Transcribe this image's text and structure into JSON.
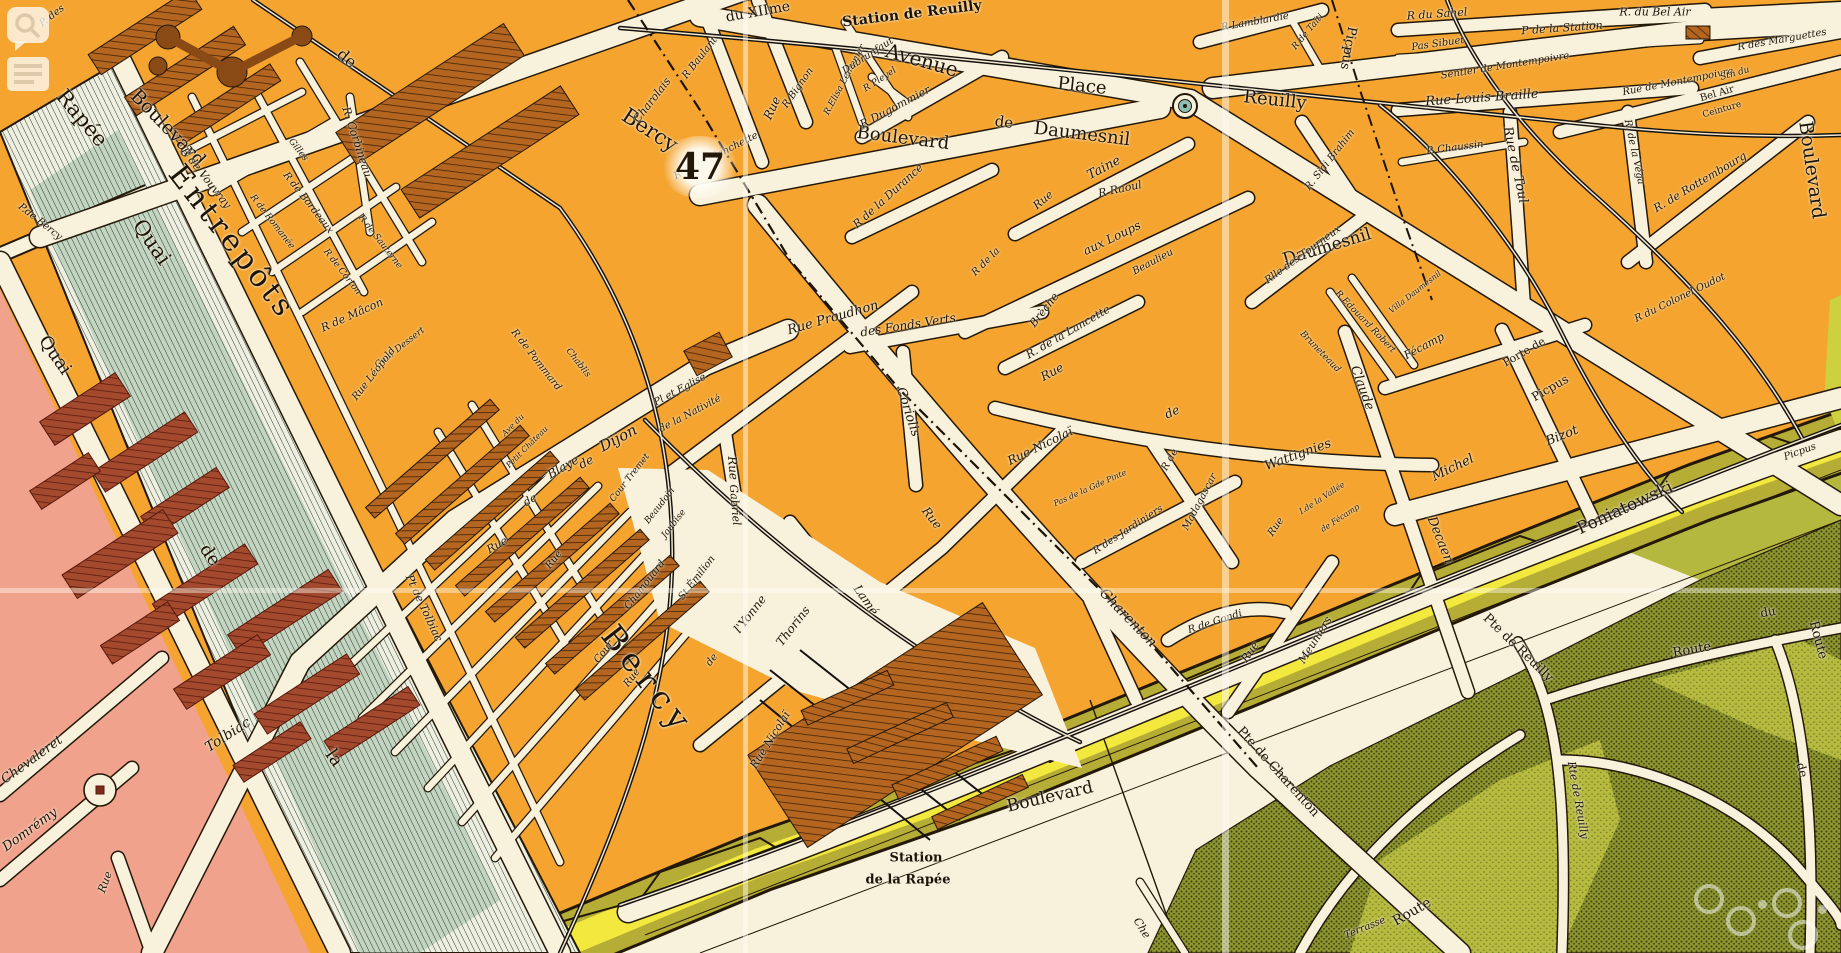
{
  "map": {
    "sheet_number": "47",
    "description_labels": {
      "station_line1": "Station",
      "station_line2": "de la Rapée"
    },
    "colors": {
      "block_orange": "#f4a42f",
      "street_cream": "#f8f1dc",
      "building_hatch": "#b4651f",
      "left_bank_pink": "#f0a28c",
      "left_bank_building": "#a2492e",
      "river_hatch_base": "#edf0e1",
      "river_teal": "#9fc0a8",
      "fortification_yellow": "#f2e83e",
      "fortification_olive": "#b5ad35",
      "park_dark": "#8d9430",
      "park_light": "#b6bb40",
      "ink": "#241808",
      "place_circle_teal": "#8fbfb4"
    },
    "overlay_icons": [
      "speech-bubble-magnifier-icon",
      "text-lines-icon",
      "watermark-rings"
    ],
    "labels": [
      {
        "t": "P. des",
        "x": 52,
        "y": 16,
        "r": -38,
        "s": 10,
        "i": 1
      },
      {
        "t": "Rapée",
        "x": 82,
        "y": 118,
        "r": 50,
        "s": 21
      },
      {
        "t": "Quai",
        "x": 152,
        "y": 242,
        "r": 55,
        "s": 21
      },
      {
        "t": "P.de Bercy",
        "x": 40,
        "y": 222,
        "r": 38,
        "s": 10,
        "i": 1
      },
      {
        "t": "Boulevard",
        "x": 168,
        "y": 128,
        "r": 46,
        "s": 19
      },
      {
        "t": "de",
        "x": 347,
        "y": 58,
        "r": 40,
        "s": 16
      },
      {
        "t": "Bercy",
        "x": 650,
        "y": 130,
        "r": 33,
        "s": 21
      },
      {
        "t": "du XIIme",
        "x": 758,
        "y": 12,
        "r": -10,
        "s": 14
      },
      {
        "t": "Station de Reuilly",
        "x": 912,
        "y": 14,
        "r": -7,
        "s": 14,
        "b": 1
      },
      {
        "t": "Avenue",
        "x": 922,
        "y": 60,
        "r": 16,
        "s": 20
      },
      {
        "t": "Place",
        "x": 1082,
        "y": 86,
        "r": 6,
        "s": 18
      },
      {
        "t": "Reuilly",
        "x": 1275,
        "y": 100,
        "r": 6,
        "s": 18
      },
      {
        "t": "Boulevard",
        "x": 903,
        "y": 138,
        "r": 7,
        "s": 18
      },
      {
        "t": "de",
        "x": 1004,
        "y": 122,
        "r": 7,
        "s": 15
      },
      {
        "t": "Daumesnil",
        "x": 1082,
        "y": 134,
        "r": 7,
        "s": 18
      },
      {
        "t": "Daumesnil",
        "x": 1327,
        "y": 247,
        "r": -17,
        "s": 17
      },
      {
        "t": "R Baulant",
        "x": 700,
        "y": 58,
        "r": -52,
        "s": 10,
        "i": 1
      },
      {
        "t": "Charolais",
        "x": 652,
        "y": 100,
        "r": -52,
        "s": 11,
        "i": 1
      },
      {
        "t": "R Bignon",
        "x": 798,
        "y": 88,
        "r": -55,
        "s": 10,
        "i": 1
      },
      {
        "t": "Rue",
        "x": 772,
        "y": 108,
        "r": -65,
        "s": 12,
        "i": 1
      },
      {
        "t": "R de la Planchette",
        "x": 716,
        "y": 156,
        "r": -27,
        "s": 10,
        "i": 1
      },
      {
        "t": "R.Elisa Lemonier",
        "x": 845,
        "y": 80,
        "r": -62,
        "s": 9,
        "i": 1
      },
      {
        "t": "Dubrunfaut",
        "x": 868,
        "y": 56,
        "r": -33,
        "s": 10,
        "i": 1
      },
      {
        "t": "R Pleyel",
        "x": 880,
        "y": 80,
        "r": -33,
        "s": 9,
        "i": 1
      },
      {
        "t": "R Dugommier",
        "x": 895,
        "y": 107,
        "r": -28,
        "s": 11,
        "i": 1
      },
      {
        "t": "R de la Durance",
        "x": 888,
        "y": 196,
        "r": -42,
        "s": 11,
        "i": 1
      },
      {
        "t": "Rue",
        "x": 1043,
        "y": 200,
        "r": -40,
        "s": 11,
        "i": 1
      },
      {
        "t": "Taine",
        "x": 1104,
        "y": 168,
        "r": -28,
        "s": 13,
        "i": 1
      },
      {
        "t": "R Raoul",
        "x": 1120,
        "y": 189,
        "r": -12,
        "s": 11,
        "i": 1
      },
      {
        "t": "R de la",
        "x": 986,
        "y": 262,
        "r": -45,
        "s": 10,
        "i": 1
      },
      {
        "t": "Brèche",
        "x": 1044,
        "y": 310,
        "r": -52,
        "s": 11,
        "i": 1
      },
      {
        "t": "aux Loups",
        "x": 1112,
        "y": 238,
        "r": -26,
        "s": 12,
        "i": 1
      },
      {
        "t": "Beaulieu",
        "x": 1153,
        "y": 262,
        "r": -28,
        "s": 10,
        "i": 1
      },
      {
        "t": "R Lamblardie",
        "x": 1255,
        "y": 22,
        "r": -10,
        "s": 10,
        "i": 1
      },
      {
        "t": "R de Taïti",
        "x": 1308,
        "y": 32,
        "r": -50,
        "s": 9,
        "i": 1
      },
      {
        "t": "Picpus",
        "x": 1348,
        "y": 48,
        "r": 100,
        "s": 13
      },
      {
        "t": "R. Sidi Brahim",
        "x": 1330,
        "y": 160,
        "r": -52,
        "s": 10,
        "i": 1
      },
      {
        "t": "Rlle des Tourneux",
        "x": 1303,
        "y": 255,
        "r": -36,
        "s": 10,
        "i": 1
      },
      {
        "t": "R.Edouard Robert",
        "x": 1365,
        "y": 322,
        "r": 46,
        "s": 9,
        "i": 1
      },
      {
        "t": "Bruneteaud",
        "x": 1320,
        "y": 352,
        "r": 46,
        "s": 9,
        "i": 1
      },
      {
        "t": "Villa Daumesnil",
        "x": 1415,
        "y": 292,
        "r": -38,
        "s": 8,
        "i": 1
      },
      {
        "t": "Fécamp",
        "x": 1424,
        "y": 346,
        "r": -28,
        "s": 11,
        "i": 1
      },
      {
        "t": "Claude",
        "x": 1362,
        "y": 388,
        "r": 70,
        "s": 13,
        "i": 1
      },
      {
        "t": "Decaen",
        "x": 1440,
        "y": 540,
        "r": 68,
        "s": 13,
        "i": 1
      },
      {
        "t": "Michel",
        "x": 1453,
        "y": 468,
        "r": -26,
        "s": 13,
        "i": 1
      },
      {
        "t": "Bizot",
        "x": 1562,
        "y": 436,
        "r": -22,
        "s": 13,
        "i": 1
      },
      {
        "t": "Wattignies",
        "x": 1298,
        "y": 455,
        "r": -20,
        "s": 13,
        "i": 1
      },
      {
        "t": "de",
        "x": 1172,
        "y": 412,
        "r": -25,
        "s": 12,
        "i": 1
      },
      {
        "t": "Rue",
        "x": 1052,
        "y": 372,
        "r": -28,
        "s": 12,
        "i": 1
      },
      {
        "t": "Rue Nicolaï",
        "x": 1040,
        "y": 446,
        "r": -26,
        "s": 12,
        "i": 1
      },
      {
        "t": "R. de la Lancette",
        "x": 1068,
        "y": 332,
        "r": -30,
        "s": 11,
        "i": 1
      },
      {
        "t": "Pas de la Gde Pinte",
        "x": 1090,
        "y": 488,
        "r": -24,
        "s": 8,
        "i": 1
      },
      {
        "t": "R de",
        "x": 1170,
        "y": 460,
        "r": -60,
        "s": 10,
        "i": 1
      },
      {
        "t": "Madagascar",
        "x": 1200,
        "y": 502,
        "r": -62,
        "s": 10,
        "i": 1
      },
      {
        "t": "R des Jardiniers",
        "x": 1128,
        "y": 530,
        "r": -33,
        "s": 10,
        "i": 1
      },
      {
        "t": "Rue",
        "x": 1276,
        "y": 527,
        "r": -55,
        "s": 10,
        "i": 1
      },
      {
        "t": "Rue",
        "x": 1250,
        "y": 652,
        "r": -55,
        "s": 11,
        "i": 1
      },
      {
        "t": "Meuniers",
        "x": 1315,
        "y": 640,
        "r": -58,
        "s": 11,
        "i": 1
      },
      {
        "t": "R de Gondi",
        "x": 1215,
        "y": 622,
        "r": -18,
        "s": 10,
        "i": 1
      },
      {
        "t": "I.de la Vallée",
        "x": 1322,
        "y": 498,
        "r": -33,
        "s": 8,
        "i": 1
      },
      {
        "t": "de Fécamp",
        "x": 1340,
        "y": 518,
        "r": -33,
        "s": 8,
        "i": 1
      },
      {
        "t": "Charenton",
        "x": 1128,
        "y": 618,
        "r": 46,
        "s": 14,
        "i": 1
      },
      {
        "t": "Rue",
        "x": 932,
        "y": 518,
        "r": 52,
        "s": 12,
        "i": 1
      },
      {
        "t": "Coriolis",
        "x": 908,
        "y": 412,
        "r": 72,
        "s": 13,
        "i": 1
      },
      {
        "t": "Rue Proudhon",
        "x": 833,
        "y": 318,
        "r": -16,
        "s": 13,
        "i": 1
      },
      {
        "t": "des Fonds Verts",
        "x": 908,
        "y": 325,
        "r": -9,
        "s": 12,
        "i": 1
      },
      {
        "t": "Pl et Eglise",
        "x": 680,
        "y": 390,
        "r": -28,
        "s": 10,
        "i": 1
      },
      {
        "t": "de la Nativité",
        "x": 690,
        "y": 414,
        "r": -28,
        "s": 10,
        "i": 1
      },
      {
        "t": "Rue",
        "x": 733,
        "y": 468,
        "r": 85,
        "s": 12,
        "i": 1
      },
      {
        "t": "Gabriel",
        "x": 735,
        "y": 505,
        "r": 85,
        "s": 11,
        "i": 1
      },
      {
        "t": "Lamé",
        "x": 866,
        "y": 600,
        "r": 55,
        "s": 12,
        "i": 1
      },
      {
        "t": "de",
        "x": 586,
        "y": 462,
        "r": -28,
        "s": 12,
        "i": 1
      },
      {
        "t": "Dijon",
        "x": 618,
        "y": 438,
        "r": -28,
        "s": 15,
        "i": 1
      },
      {
        "t": "Rue",
        "x": 497,
        "y": 545,
        "r": -30,
        "s": 11,
        "i": 1
      },
      {
        "t": "de",
        "x": 530,
        "y": 500,
        "r": -30,
        "s": 11,
        "i": 1
      },
      {
        "t": "Blaye",
        "x": 563,
        "y": 467,
        "r": -30,
        "s": 12,
        "i": 1
      },
      {
        "t": "Ave du",
        "x": 513,
        "y": 425,
        "r": -45,
        "s": 8,
        "i": 1
      },
      {
        "t": "Petit Château",
        "x": 527,
        "y": 447,
        "r": -45,
        "s": 8,
        "i": 1
      },
      {
        "t": "R de Pommard",
        "x": 536,
        "y": 360,
        "r": 52,
        "s": 10,
        "i": 1
      },
      {
        "t": "Chablis",
        "x": 578,
        "y": 363,
        "r": 52,
        "s": 9,
        "i": 1
      },
      {
        "t": "R de Vouvray",
        "x": 206,
        "y": 178,
        "r": 52,
        "s": 11,
        "i": 1
      },
      {
        "t": "Gilles",
        "x": 298,
        "y": 150,
        "r": 52,
        "s": 9,
        "i": 1
      },
      {
        "t": "R de Romanée",
        "x": 272,
        "y": 222,
        "r": 52,
        "s": 9,
        "i": 1
      },
      {
        "t": "R de Bordeaux",
        "x": 308,
        "y": 203,
        "r": 52,
        "s": 10,
        "i": 1
      },
      {
        "t": "R de Corton",
        "x": 342,
        "y": 272,
        "r": 52,
        "s": 9,
        "i": 1
      },
      {
        "t": "R de Sauterne",
        "x": 380,
        "y": 242,
        "r": 52,
        "s": 9,
        "i": 1
      },
      {
        "t": "R de Mâcon",
        "x": 352,
        "y": 315,
        "r": -24,
        "s": 11,
        "i": 1
      },
      {
        "t": "Cour Dessert",
        "x": 400,
        "y": 348,
        "r": -38,
        "s": 9,
        "i": 1
      },
      {
        "t": "Rue Léopold",
        "x": 374,
        "y": 374,
        "r": -52,
        "s": 10,
        "i": 1
      },
      {
        "t": "R. Corbineau",
        "x": 357,
        "y": 142,
        "r": 72,
        "s": 11,
        "i": 1
      },
      {
        "t": "Entrepôts",
        "x": 232,
        "y": 242,
        "r": 52,
        "s": 30,
        "sp": 4
      },
      {
        "t": "Bercy",
        "x": 648,
        "y": 680,
        "r": 52,
        "s": 32,
        "sp": 7
      },
      {
        "t": "Rue",
        "x": 554,
        "y": 560,
        "r": -52,
        "s": 10,
        "i": 1
      },
      {
        "t": "Cour",
        "x": 604,
        "y": 652,
        "r": -52,
        "s": 10,
        "i": 1
      },
      {
        "t": "Rue",
        "x": 632,
        "y": 678,
        "r": -52,
        "s": 10,
        "i": 1
      },
      {
        "t": "Cour Tremet",
        "x": 630,
        "y": 478,
        "r": -52,
        "s": 9,
        "i": 1
      },
      {
        "t": "Beaudoin",
        "x": 660,
        "y": 506,
        "r": -52,
        "s": 9,
        "i": 1
      },
      {
        "t": "Joubise",
        "x": 674,
        "y": 524,
        "r": -52,
        "s": 9,
        "i": 1
      },
      {
        "t": "Chamouard",
        "x": 645,
        "y": 585,
        "r": -52,
        "s": 10,
        "i": 1
      },
      {
        "t": "St Émilion",
        "x": 697,
        "y": 578,
        "r": -52,
        "s": 10,
        "i": 1
      },
      {
        "t": "de",
        "x": 712,
        "y": 660,
        "r": -52,
        "s": 10,
        "i": 1
      },
      {
        "t": "l'Yonne",
        "x": 750,
        "y": 614,
        "r": -52,
        "s": 12,
        "i": 1
      },
      {
        "t": "Thorins",
        "x": 793,
        "y": 626,
        "r": -52,
        "s": 12,
        "i": 1
      },
      {
        "t": "Rue Nicolaï",
        "x": 770,
        "y": 740,
        "r": -58,
        "s": 11,
        "i": 1
      },
      {
        "t": "Pt de Tolbiac",
        "x": 424,
        "y": 608,
        "r": 65,
        "s": 11,
        "i": 1
      },
      {
        "t": "Tolbiac",
        "x": 228,
        "y": 735,
        "r": -33,
        "s": 14,
        "i": 1
      },
      {
        "t": "Chevaleret",
        "x": 32,
        "y": 760,
        "r": -36,
        "s": 13,
        "i": 1
      },
      {
        "t": "Domrémy",
        "x": 30,
        "y": 830,
        "r": -36,
        "s": 13,
        "i": 1
      },
      {
        "t": "Rue",
        "x": 105,
        "y": 882,
        "r": -70,
        "s": 11,
        "i": 1
      },
      {
        "t": "Quai",
        "x": 55,
        "y": 355,
        "r": 55,
        "s": 18
      },
      {
        "t": "de",
        "x": 210,
        "y": 555,
        "r": 55,
        "s": 18
      },
      {
        "t": "la",
        "x": 334,
        "y": 758,
        "r": 55,
        "s": 18
      },
      {
        "t": "Pte de Charenton",
        "x": 1278,
        "y": 772,
        "r": 48,
        "s": 13
      },
      {
        "t": "Route",
        "x": 1412,
        "y": 912,
        "r": -30,
        "s": 14
      },
      {
        "t": "Terrasse",
        "x": 1365,
        "y": 928,
        "r": -22,
        "s": 10,
        "i": 1
      },
      {
        "t": "Boulevard",
        "x": 1050,
        "y": 797,
        "r": -13,
        "s": 17
      },
      {
        "t": "Poniatowski",
        "x": 1625,
        "y": 508,
        "r": -25,
        "s": 17
      },
      {
        "t": "Pte de Reuilly",
        "x": 1518,
        "y": 648,
        "r": 44,
        "s": 13
      },
      {
        "t": "Rte de Reuilly",
        "x": 1578,
        "y": 800,
        "r": 80,
        "s": 11,
        "i": 1
      },
      {
        "t": "Route",
        "x": 1692,
        "y": 650,
        "r": -10,
        "s": 13
      },
      {
        "t": "du",
        "x": 1768,
        "y": 612,
        "r": -10,
        "s": 12
      },
      {
        "t": "de",
        "x": 1802,
        "y": 770,
        "r": 75,
        "s": 12
      },
      {
        "t": "Route",
        "x": 1818,
        "y": 640,
        "r": 75,
        "s": 13
      },
      {
        "t": "Che",
        "x": 1142,
        "y": 928,
        "r": 58,
        "s": 11,
        "i": 1
      },
      {
        "t": "Sentier de Montempoivre",
        "x": 1505,
        "y": 66,
        "r": -9,
        "s": 10,
        "i": 1
      },
      {
        "t": "Pas Sibuet",
        "x": 1438,
        "y": 44,
        "r": -8,
        "s": 10,
        "i": 1
      },
      {
        "t": "R du Sahel",
        "x": 1437,
        "y": 14,
        "r": -4,
        "s": 11,
        "i": 1
      },
      {
        "t": "P de la Station",
        "x": 1562,
        "y": 28,
        "r": -4,
        "s": 11,
        "i": 1
      },
      {
        "t": "R. du Bel Air",
        "x": 1655,
        "y": 12,
        "r": 0,
        "s": 11,
        "i": 1
      },
      {
        "t": "Rue Louis Braille",
        "x": 1482,
        "y": 98,
        "r": -4,
        "s": 13,
        "i": 1
      },
      {
        "t": "P. Chaussin",
        "x": 1455,
        "y": 148,
        "r": -7,
        "s": 10,
        "i": 1
      },
      {
        "t": "Rue de Toul",
        "x": 1515,
        "y": 165,
        "r": 78,
        "s": 13,
        "i": 1
      },
      {
        "t": "Rue de Montempoivre",
        "x": 1678,
        "y": 82,
        "r": -11,
        "s": 10,
        "i": 1
      },
      {
        "t": "R des Marguettes",
        "x": 1782,
        "y": 40,
        "r": -10,
        "s": 10,
        "i": 1
      },
      {
        "t": "Stn du",
        "x": 1735,
        "y": 74,
        "r": -16,
        "s": 9,
        "i": 1
      },
      {
        "t": "Bel Air",
        "x": 1717,
        "y": 94,
        "r": -16,
        "s": 10
      },
      {
        "t": "Ceinture",
        "x": 1722,
        "y": 110,
        "r": -16,
        "s": 9
      },
      {
        "t": "R. de la Véga",
        "x": 1634,
        "y": 152,
        "r": 78,
        "s": 10,
        "i": 1
      },
      {
        "t": "R. de Rottembourg",
        "x": 1700,
        "y": 182,
        "r": -31,
        "s": 11,
        "i": 1
      },
      {
        "t": "Boulevard",
        "x": 1812,
        "y": 170,
        "r": 82,
        "s": 19
      },
      {
        "t": "R du Colonel Oudot",
        "x": 1680,
        "y": 298,
        "r": -26,
        "s": 10,
        "i": 1
      },
      {
        "t": "Porte de",
        "x": 1524,
        "y": 352,
        "r": -30,
        "s": 11
      },
      {
        "t": "Picpus",
        "x": 1550,
        "y": 388,
        "r": -30,
        "s": 12
      },
      {
        "t": "Picpus",
        "x": 1800,
        "y": 452,
        "r": -20,
        "s": 10,
        "i": 1
      },
      {
        "t": "Station",
        "x": 916,
        "y": 858,
        "r": 0,
        "s": 13,
        "b": 1
      },
      {
        "t": "de la Rapée",
        "x": 908,
        "y": 880,
        "r": 0,
        "s": 13,
        "b": 1
      }
    ]
  }
}
